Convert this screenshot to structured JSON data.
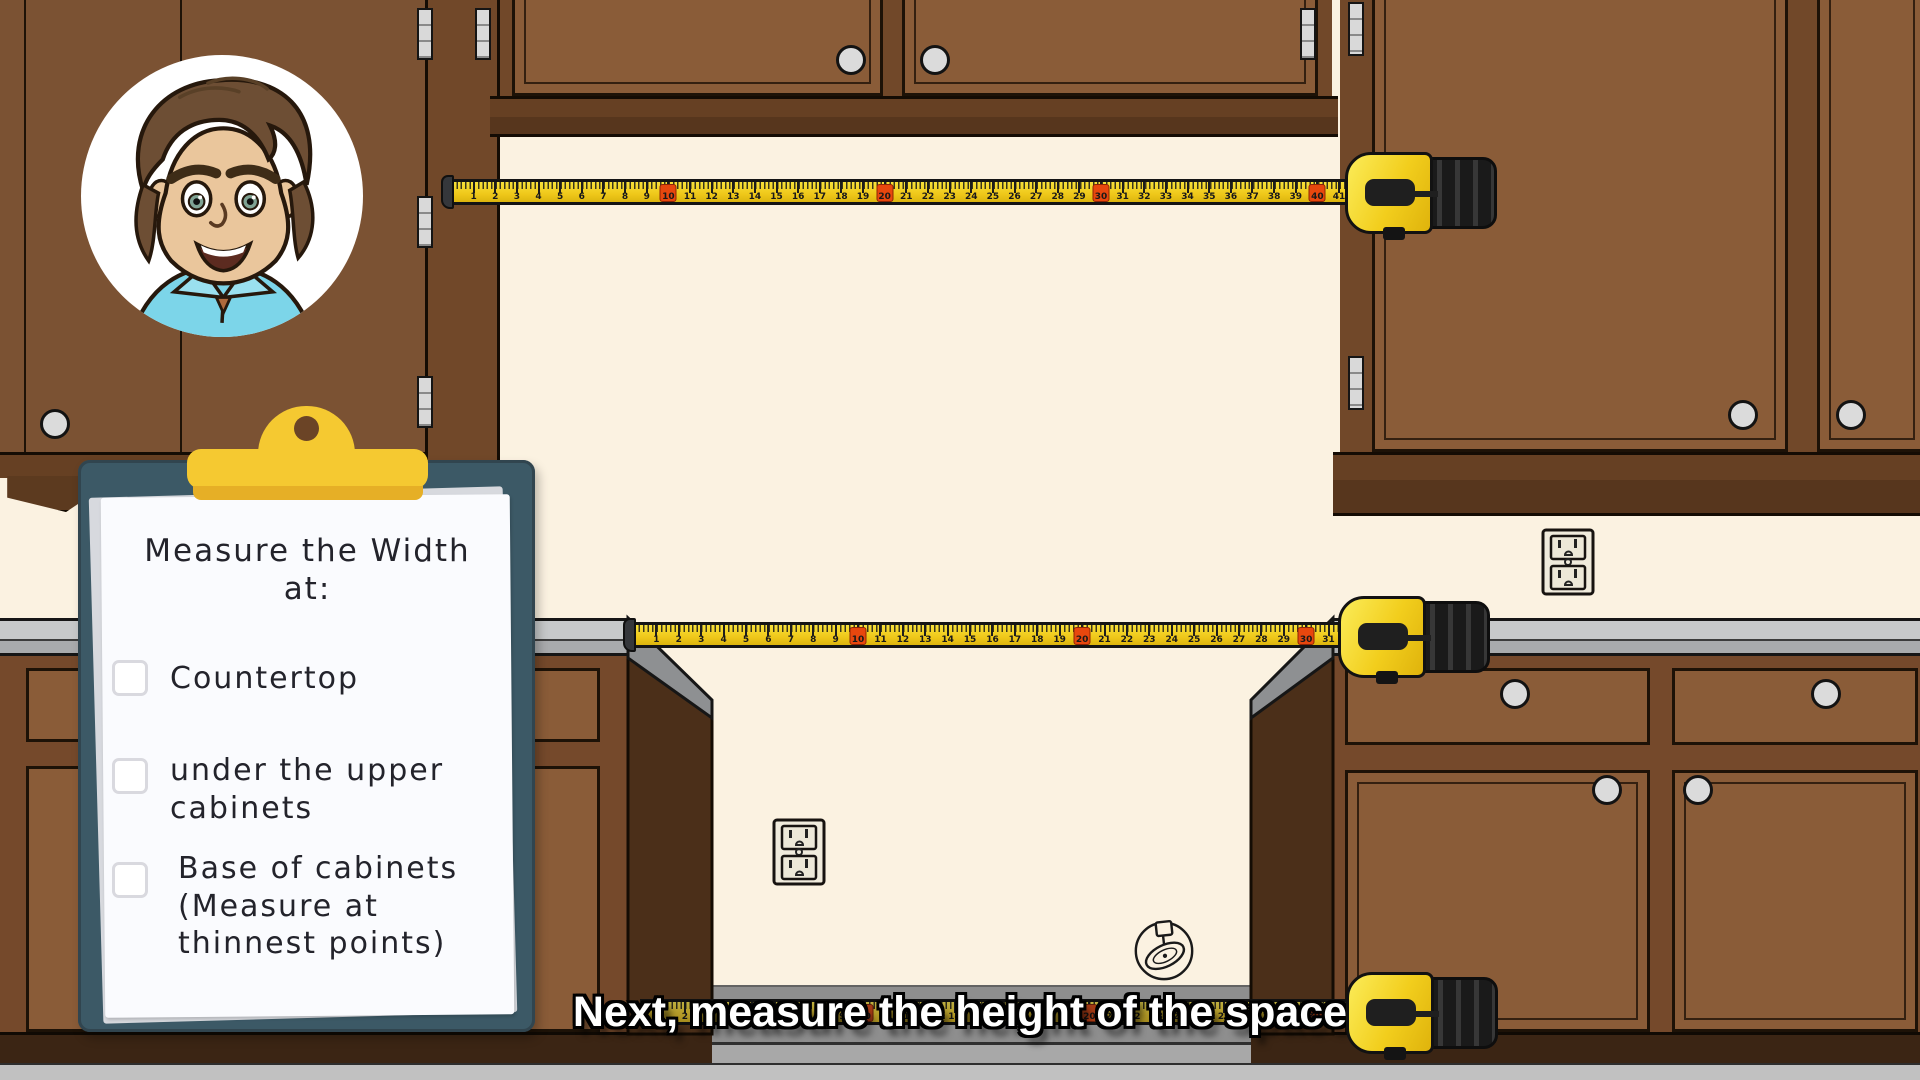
{
  "scene": {
    "caption": "Next, measure the height of the space",
    "description": "cartoon kitchen with upper and lower cabinets, appliance gap, three tape measures"
  },
  "clipboard": {
    "title": "Measure the Width\nat:",
    "items": [
      {
        "label": "Countertop",
        "checked": false
      },
      {
        "label": "under the upper\ncabinets",
        "checked": false
      },
      {
        "label": "Base of cabinets\n(Measure at\nthinnest points)",
        "checked": false
      }
    ]
  },
  "tapes": [
    {
      "id": "tape-top",
      "start": 1,
      "end": 41,
      "marker_interval": 10
    },
    {
      "id": "tape-mid",
      "start": 1,
      "end": 31,
      "marker_interval": 10
    },
    {
      "id": "tape-bottom",
      "start": 1,
      "end": 31,
      "marker_interval": 10
    }
  ],
  "colors": {
    "wall": "#FBF2E1",
    "cabinet_brown": "#7B5233",
    "door_brown": "#8A5C38",
    "tape_yellow": "#EFC81A",
    "tape_marker_red": "#E8470E",
    "clip_yellow": "#F5C931",
    "board_teal": "#3C5966",
    "countertop_gray": "#C7C9CA"
  }
}
